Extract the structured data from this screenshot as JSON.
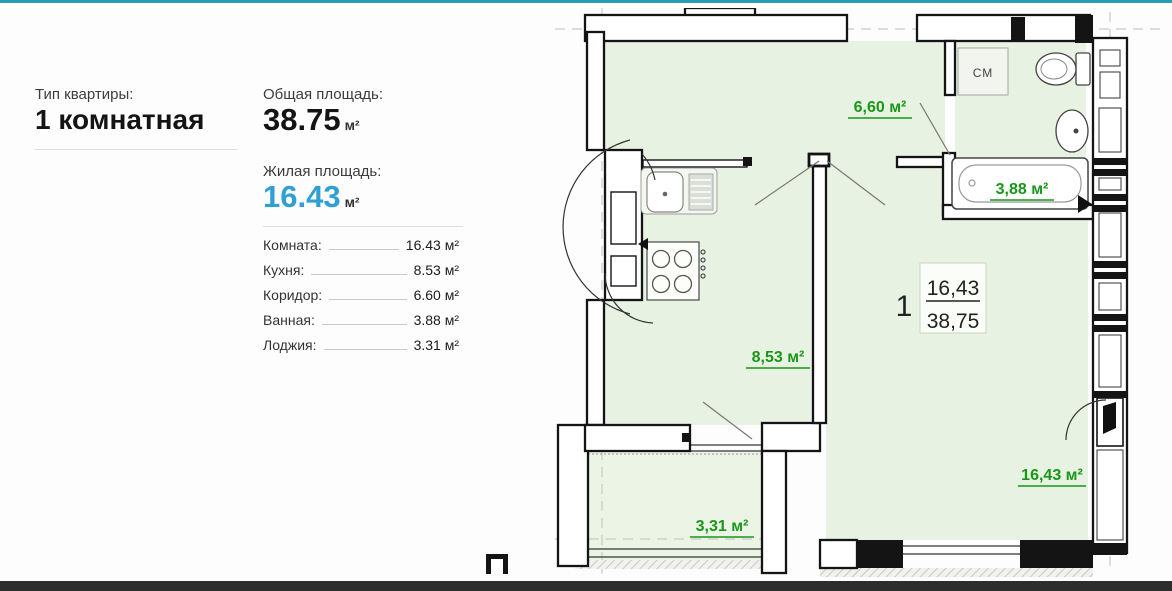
{
  "page": {
    "top_rule_color": "#2a9cb4",
    "bottom_bar_color": "#2d2d2d",
    "accent_blue": "#2f9fd4",
    "plan_label_green": "#189818",
    "plan_room_fill": "#e8f2e2"
  },
  "details": {
    "type_label": "Тип квартиры:",
    "type_value": "1 комнатная",
    "total_area_label": "Общая площадь:",
    "total_area_value": "38.75",
    "total_area_unit": "м²",
    "living_area_label": "Жилая площадь:",
    "living_area_value": "16.43",
    "living_area_unit": "м²",
    "rooms": [
      {
        "label": "Комната:",
        "value": "16.43 м²"
      },
      {
        "label": "Кухня:",
        "value": "8.53 м²"
      },
      {
        "label": "Коридор:",
        "value": "6.60 м²"
      },
      {
        "label": "Ванная:",
        "value": "3.88 м²"
      },
      {
        "label": "Лоджия:",
        "value": "3.31 м²"
      }
    ]
  },
  "plan": {
    "apartment_number": "1",
    "fraction_living": "16,43",
    "fraction_total": "38,75",
    "labels": {
      "hall": "6,60 м²",
      "bath": "3,88 м²",
      "kitchen": "8,53 м²",
      "room": "16,43 м²",
      "loggia": "3,31 м²",
      "washer": "СМ"
    }
  }
}
